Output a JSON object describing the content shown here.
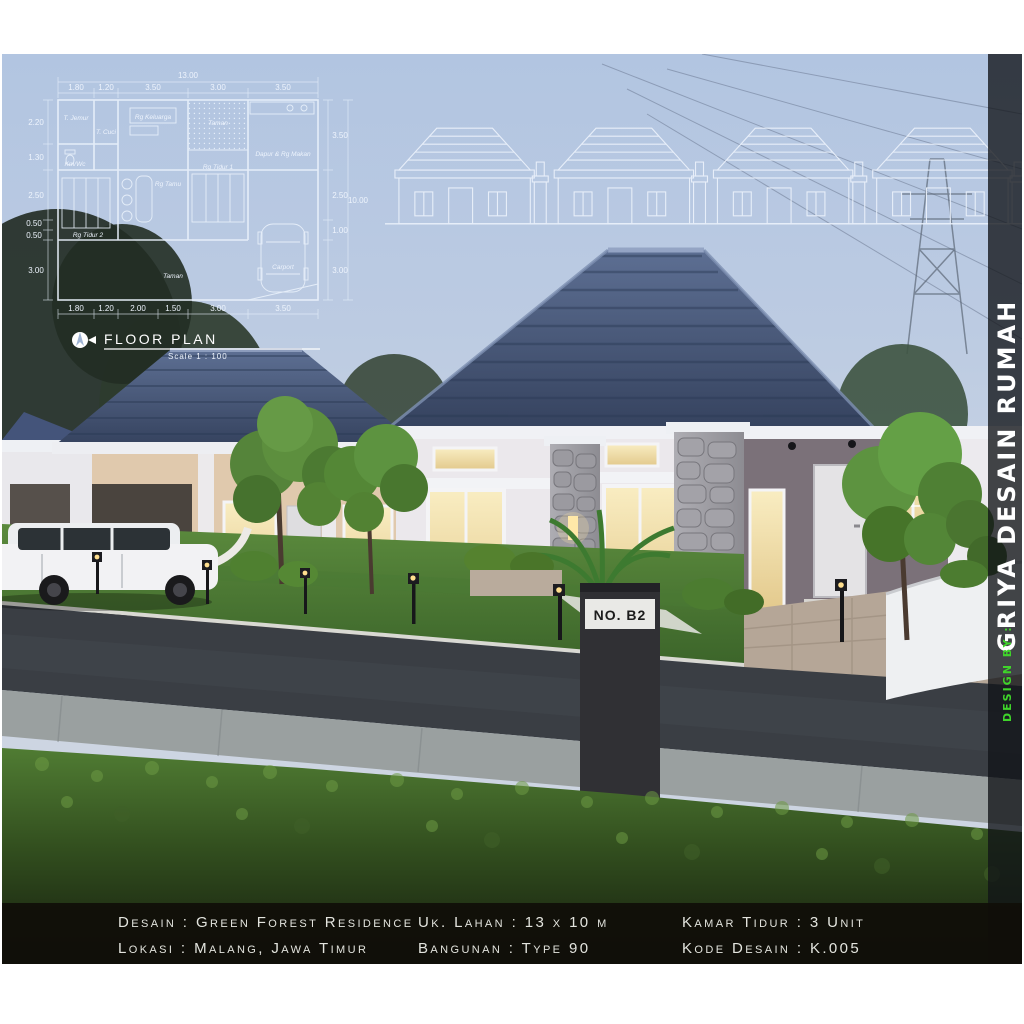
{
  "colors": {
    "accent_green": "#3fd42a",
    "roof_blue": "#46587c",
    "sky": "#b2c5e1",
    "bar_bg": "#100e09",
    "blueprint_line": "#e9f1fb"
  },
  "floor_plan": {
    "title": "FLOOR PLAN",
    "scale": "Scale 1 : 100",
    "overall_width": "13.00",
    "overall_height": "10.00",
    "dims_top": [
      "1.80",
      "1.20",
      "3.50",
      "3.00",
      "3.50"
    ],
    "dims_bottom": [
      "1.80",
      "1.20",
      "2.00",
      "1.50",
      "3.00",
      "3.50"
    ],
    "dims_left": [
      "2.20",
      "1.30",
      "2.50",
      "0.50",
      "0.50",
      "3.00"
    ],
    "dims_right": [
      "3.50",
      "2.50",
      "1.00",
      "3.00"
    ],
    "rooms": {
      "jemur": "T. Jemur",
      "cuci": "T. Cuci",
      "kmwc": "Km/Wc",
      "keluarga": "Rg Keluarga",
      "taman_tengah": "Taman",
      "dapur": "Dapur & Rg Makan",
      "tamu": "Rg Tamu",
      "tidur1": "Rg Tidur 1",
      "tidur2": "Rg Tidur 2",
      "carport": "Carport",
      "taman_depan": "Taman"
    }
  },
  "scene": {
    "house_sign": "NO. B2"
  },
  "sidebar": {
    "brand": "GRIYA DESAIN RUMAH",
    "credit": "DESIGN BY :"
  },
  "info_bar": {
    "col1": [
      "Desain : Green Forest Residence",
      "Lokasi : Malang, Jawa Timur"
    ],
    "col2": [
      "Uk. Lahan : 13 x 10 m",
      "Bangunan : Type 90"
    ],
    "col3": [
      "Kamar Tidur : 3 Unit",
      "Kode Desain : K.005"
    ]
  }
}
